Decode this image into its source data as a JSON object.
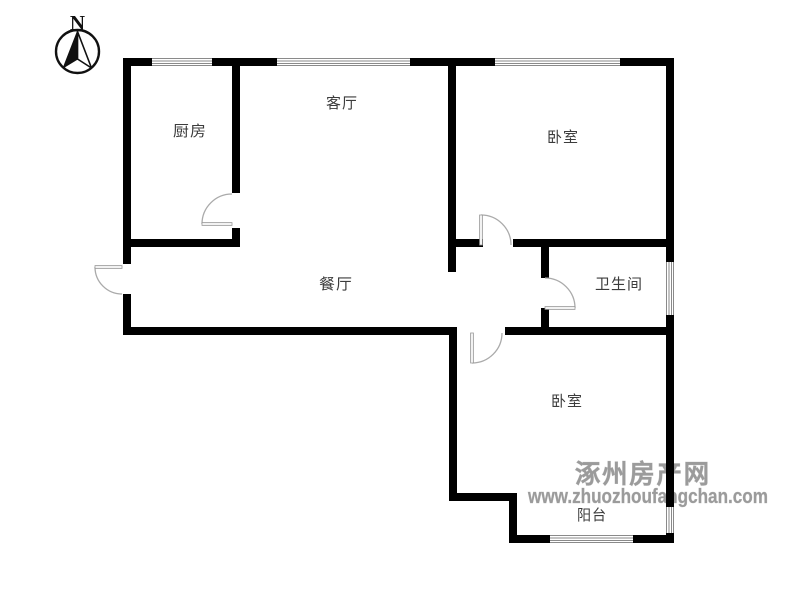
{
  "compass": {
    "label": "N"
  },
  "rooms": [
    {
      "id": "kitchen",
      "label": "厨房"
    },
    {
      "id": "living-room",
      "label": "客厅"
    },
    {
      "id": "bedroom-north",
      "label": "卧室"
    },
    {
      "id": "dining-room",
      "label": "餐厅"
    },
    {
      "id": "bathroom",
      "label": "卫生间"
    },
    {
      "id": "bedroom-south",
      "label": "卧室"
    },
    {
      "id": "balcony",
      "label": "阳台"
    }
  ],
  "watermark": {
    "site_name": "涿州房产网",
    "site_url": "www.zhuozhoufangchan.com",
    "color": "#9b9b9b"
  },
  "colors": {
    "wall": "#000000",
    "window_line": "#8a8a8a",
    "door_line": "#aaaaaa",
    "label_text": "#3c3c3c"
  }
}
